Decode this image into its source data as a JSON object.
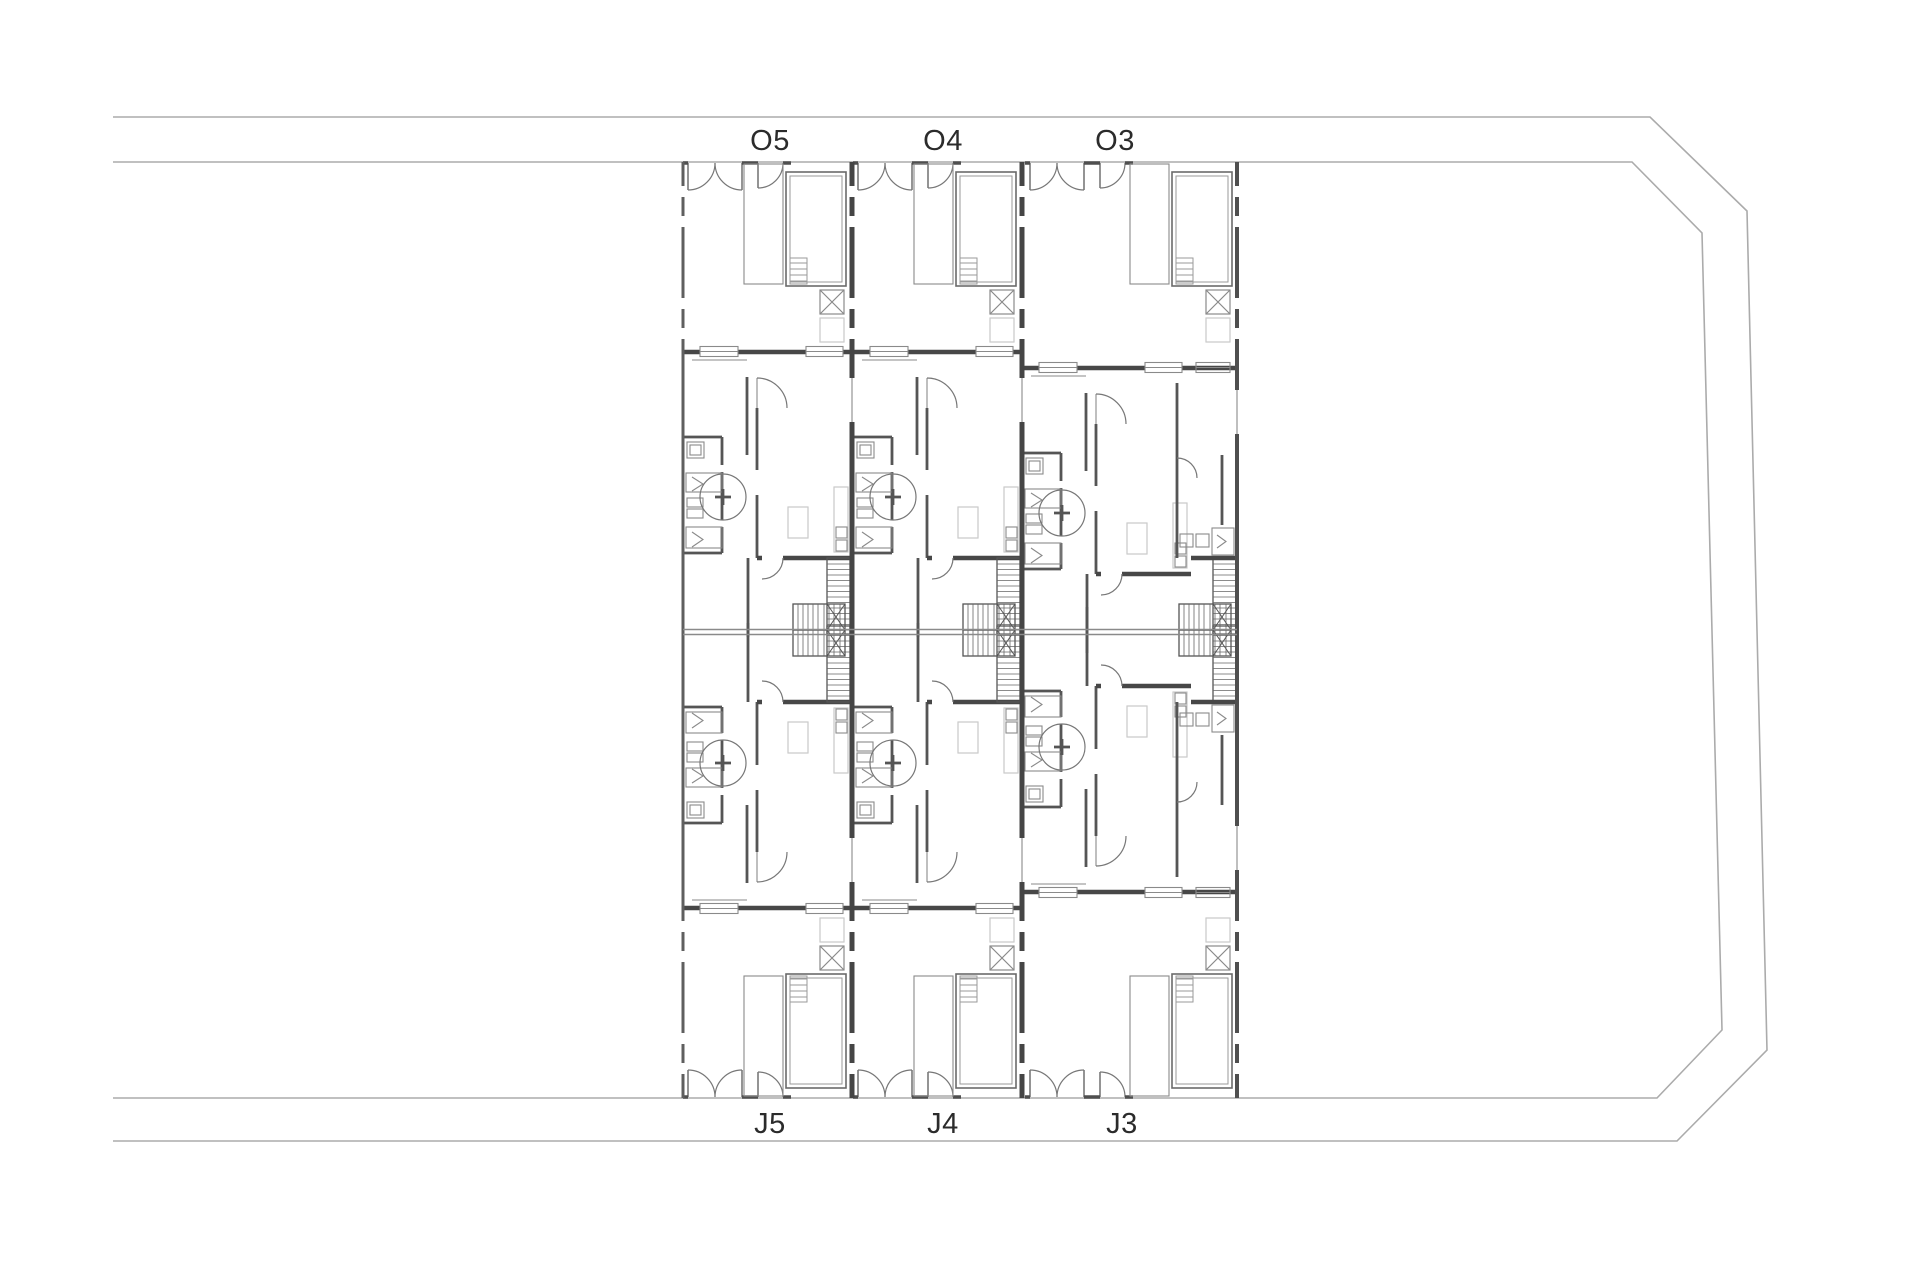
{
  "plan": {
    "units_top": [
      {
        "label": "O5"
      },
      {
        "label": "O4"
      },
      {
        "label": "O3"
      }
    ],
    "units_bottom": [
      {
        "label": "J5"
      },
      {
        "label": "J4"
      },
      {
        "label": "J3"
      }
    ],
    "features": {
      "pool": "swimming-pool",
      "deck": "terrace-deck",
      "skylight": "crossed-skylight-box",
      "stairs": "hatched-stair-flights",
      "doors": "door-swing-arcs"
    },
    "colors": {
      "background": "#ffffff",
      "wall": "#474747",
      "partition": "#555555",
      "road_line": "#ababab",
      "fixture_line": "#8a8a8a",
      "door_line": "#777777",
      "faint_furniture": "#c9c9c9",
      "label_text": "#2b2b2b"
    }
  }
}
